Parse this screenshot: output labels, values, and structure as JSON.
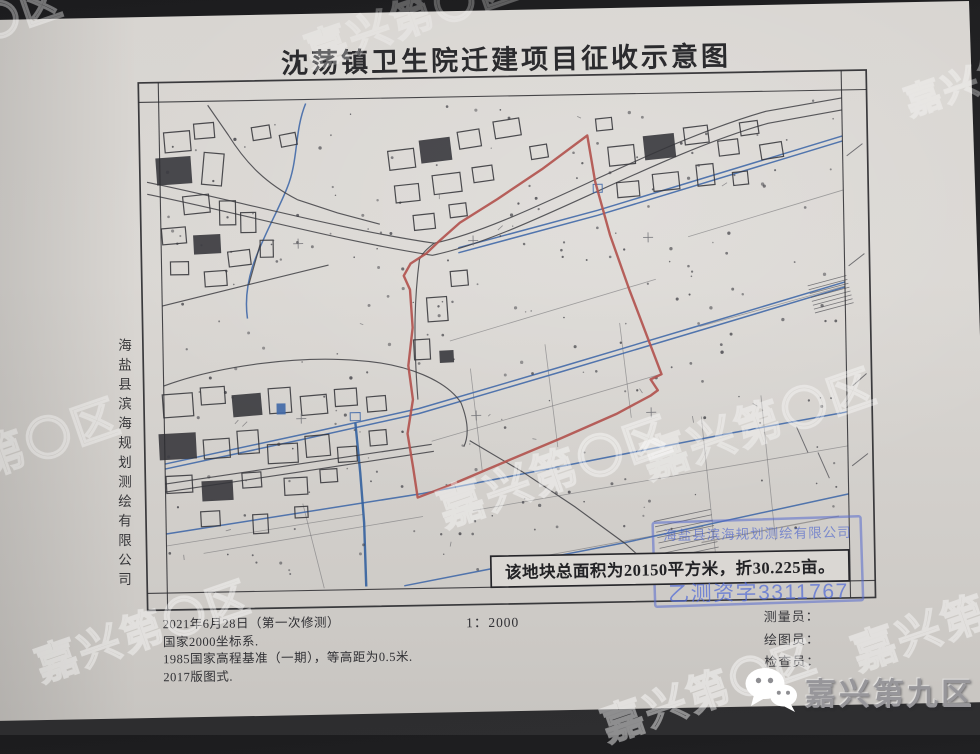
{
  "photo": {
    "background_color": "#28282a",
    "paper_color": "#d8d5d1"
  },
  "title": "沈荡镇卫生院迁建项目征收示意图",
  "side_label": "海盐县滨海规划测绘有限公司",
  "map": {
    "area_note": "该地块总面积为20150平方米，折30.225亩。",
    "stamp": {
      "company": "海盐县滨海规划测绘有限公司",
      "license": "乙测资字3311767",
      "color": "#5b74cc"
    },
    "boundary_color": "#b2544f",
    "canal_color": "#4169a8",
    "ink_color": "#3f3f44",
    "red_boundary": "M591,137 L545,170 L500,199 L462,222 L441,240 L428,252 L412,262 L405,274 L411,288 L413,326 L408,364 L412,398 L406,432 L411,466 L415,496 L448,484 L505,461 L560,439 L615,416 L650,398 L657,393 L650,382 L661,377 L648,341 L630,291 L612,237 L598,183 Z",
    "frame": {
      "outer": [
        143,
        76.5,
        728,
        527.5
      ],
      "inner_left": 163,
      "inner_right": 846,
      "inner_top": 96,
      "inner_bottom": 587
    },
    "roads": [
      "M150,176 C240,196 340,226 436,242 C520,226 650,148 770,116 L846,104",
      "M150,188 C240,208 342,238 434,254 C522,238 652,160 772,128 L846,116",
      "M436,242 C428,248 424,252 421,258 C416,292 413,332 417,398",
      "M163,380 C220,360 300,352 358,358 C408,362 446,380 460,402 C466,418 468,434 462,446",
      "M163,486 L300,468 L432,450",
      "M163,478 L300,460 L430,443",
      "M468,440 L520,472 L572,508 L622,546 L658,580",
      "M163,300 L250,280 L330,262",
      "M250,280 L262,240",
      "M212,100 L232,130 C250,160 270,180 300,196",
      "M300,196 L340,210 L382,222"
    ],
    "faint_lines": [
      "M450,340 L657,282",
      "M430,440 L660,377",
      "M470,510 L846,452",
      "M200,548 L420,515",
      "M690,240 L846,196",
      "M700,330 L846,292",
      "M163,540 L360,512",
      "M470,368 L480,470",
      "M545,345 L556,448",
      "M620,325 L630,420",
      "M700,420 L712,560",
      "M760,400 L772,545",
      "M520,560 L700,530",
      "M300,500 L320,585"
    ],
    "canals": [
      "M460,247 L600,212 L846,142",
      "M460,252 L600,217 L846,147",
      "M163,458 L300,431 L418,407 L560,368 L700,329 L846,288",
      "M163,463 L300,436 L418,412 L560,373 L700,334 L846,293",
      "M163,528 L420,492 L730,437 L846,418",
      "M400,584 L620,545 L846,500",
      "M354,420 L358,470 L361,520 L362,584",
      "M310,100 C298,128 302,156 290,184 C280,208 264,234 254,262 C248,280 246,298 248,314"
    ],
    "buildings": [
      [
        168,
        126,
        26,
        20,
        -4,
        0
      ],
      [
        198,
        118,
        20,
        15,
        -4,
        0
      ],
      [
        160,
        152,
        34,
        26,
        -3,
        1
      ],
      [
        206,
        148,
        20,
        32,
        6,
        0
      ],
      [
        186,
        190,
        26,
        18,
        -5,
        0
      ],
      [
        222,
        196,
        16,
        24,
        0,
        0
      ],
      [
        164,
        222,
        24,
        16,
        -4,
        0
      ],
      [
        196,
        230,
        26,
        18,
        -2,
        1
      ],
      [
        243,
        208,
        15,
        20,
        0,
        0
      ],
      [
        230,
        246,
        22,
        15,
        -6,
        0
      ],
      [
        172,
        256,
        18,
        13,
        0,
        0
      ],
      [
        206,
        266,
        22,
        15,
        -3,
        0
      ],
      [
        256,
        122,
        18,
        13,
        -8,
        0
      ],
      [
        262,
        236,
        13,
        17,
        0,
        0
      ],
      [
        284,
        130,
        16,
        12,
        -10,
        0
      ],
      [
        392,
        148,
        26,
        19,
        -6,
        0
      ],
      [
        424,
        138,
        30,
        22,
        -6,
        1
      ],
      [
        462,
        130,
        22,
        17,
        -8,
        0
      ],
      [
        498,
        120,
        26,
        17,
        -8,
        0
      ],
      [
        534,
        146,
        17,
        13,
        -8,
        0
      ],
      [
        398,
        183,
        24,
        17,
        -5,
        0
      ],
      [
        436,
        173,
        28,
        19,
        -6,
        0
      ],
      [
        476,
        166,
        20,
        15,
        -7,
        0
      ],
      [
        416,
        213,
        21,
        15,
        -5,
        0
      ],
      [
        452,
        203,
        17,
        13,
        -6,
        0
      ],
      [
        612,
        148,
        26,
        19,
        -5,
        0
      ],
      [
        648,
        138,
        30,
        23,
        -5,
        1
      ],
      [
        688,
        130,
        24,
        17,
        -6,
        0
      ],
      [
        722,
        144,
        20,
        15,
        -6,
        0
      ],
      [
        620,
        184,
        22,
        15,
        -4,
        0
      ],
      [
        656,
        176,
        26,
        17,
        -5,
        0
      ],
      [
        700,
        168,
        17,
        21,
        -5,
        0
      ],
      [
        744,
        126,
        18,
        13,
        -7,
        0
      ],
      [
        764,
        148,
        22,
        15,
        -8,
        0
      ],
      [
        736,
        176,
        15,
        13,
        -5,
        0
      ],
      [
        600,
        120,
        16,
        12,
        -5,
        0
      ],
      [
        428,
        296,
        20,
        24,
        -3,
        0
      ],
      [
        414,
        338,
        16,
        20,
        -2,
        0
      ],
      [
        440,
        350,
        13,
        11,
        -2,
        1
      ],
      [
        452,
        270,
        17,
        15,
        -4,
        0
      ],
      [
        162,
        388,
        30,
        23,
        -3,
        0
      ],
      [
        200,
        382,
        24,
        17,
        -3,
        0
      ],
      [
        232,
        390,
        28,
        21,
        -4,
        1
      ],
      [
        268,
        384,
        22,
        25,
        -3,
        0
      ],
      [
        300,
        392,
        26,
        19,
        -4,
        0
      ],
      [
        334,
        386,
        22,
        17,
        -3,
        0
      ],
      [
        366,
        394,
        19,
        15,
        -4,
        0
      ],
      [
        158,
        428,
        36,
        25,
        -2,
        1
      ],
      [
        202,
        434,
        26,
        19,
        -3,
        0
      ],
      [
        236,
        426,
        21,
        23,
        -3,
        0
      ],
      [
        266,
        440,
        30,
        19,
        -2,
        0
      ],
      [
        304,
        432,
        24,
        21,
        -4,
        0
      ],
      [
        336,
        444,
        19,
        15,
        -3,
        0
      ],
      [
        368,
        428,
        17,
        15,
        -4,
        0
      ],
      [
        164,
        470,
        26,
        17,
        -2,
        0
      ],
      [
        200,
        476,
        30,
        19,
        -2,
        1
      ],
      [
        240,
        468,
        19,
        15,
        -3,
        0
      ],
      [
        282,
        474,
        23,
        17,
        -2,
        0
      ],
      [
        318,
        466,
        17,
        13,
        -3,
        0
      ],
      [
        198,
        506,
        19,
        15,
        -2,
        0
      ],
      [
        250,
        510,
        15,
        19,
        -2,
        0
      ],
      [
        292,
        503,
        13,
        11,
        -2,
        0
      ]
    ],
    "blue_marks": [
      [
        596,
        186,
        9,
        8,
        0
      ],
      [
        276,
        400,
        8,
        10,
        1
      ],
      [
        349,
        410,
        10,
        8,
        0
      ]
    ],
    "hatches": [
      {
        "x": 812,
        "y": 286,
        "w": 40,
        "rows": 8,
        "gap": 4,
        "rot": -14
      },
      {
        "x": 656,
        "y": 518,
        "w": 58,
        "rows": 11,
        "gap": 5.5,
        "rot": -11
      }
    ],
    "crosses": [
      [
        300,
        240
      ],
      [
        475,
        240
      ],
      [
        650,
        240
      ],
      [
        300,
        415
      ],
      [
        475,
        415
      ],
      [
        650,
        415
      ]
    ],
    "ticks": [
      [
        850,
        162,
        866,
        150
      ],
      [
        850,
        272,
        866,
        260
      ],
      [
        852,
        392,
        866,
        380
      ],
      [
        850,
        472,
        866,
        460
      ],
      [
        795,
        432,
        806,
        458
      ],
      [
        816,
        458,
        827,
        484
      ]
    ],
    "dots": {
      "count": 250,
      "seed": 11,
      "x": 166,
      "y": 104,
      "w": 672,
      "h": 474
    }
  },
  "footer": {
    "notes": [
      "2021年6月28日（第一次修测）",
      "国家2000坐标系.",
      "1985国家高程基准（一期），等高距为0.5米.",
      "2017版图式."
    ],
    "scale": "1：2000",
    "personnel": [
      "测量员：",
      "绘图员：",
      "检查员："
    ]
  },
  "watermark": {
    "text": "嘉兴第〇区"
  },
  "branding": {
    "name": "嘉兴第九区",
    "icon": "wechat-icon"
  }
}
